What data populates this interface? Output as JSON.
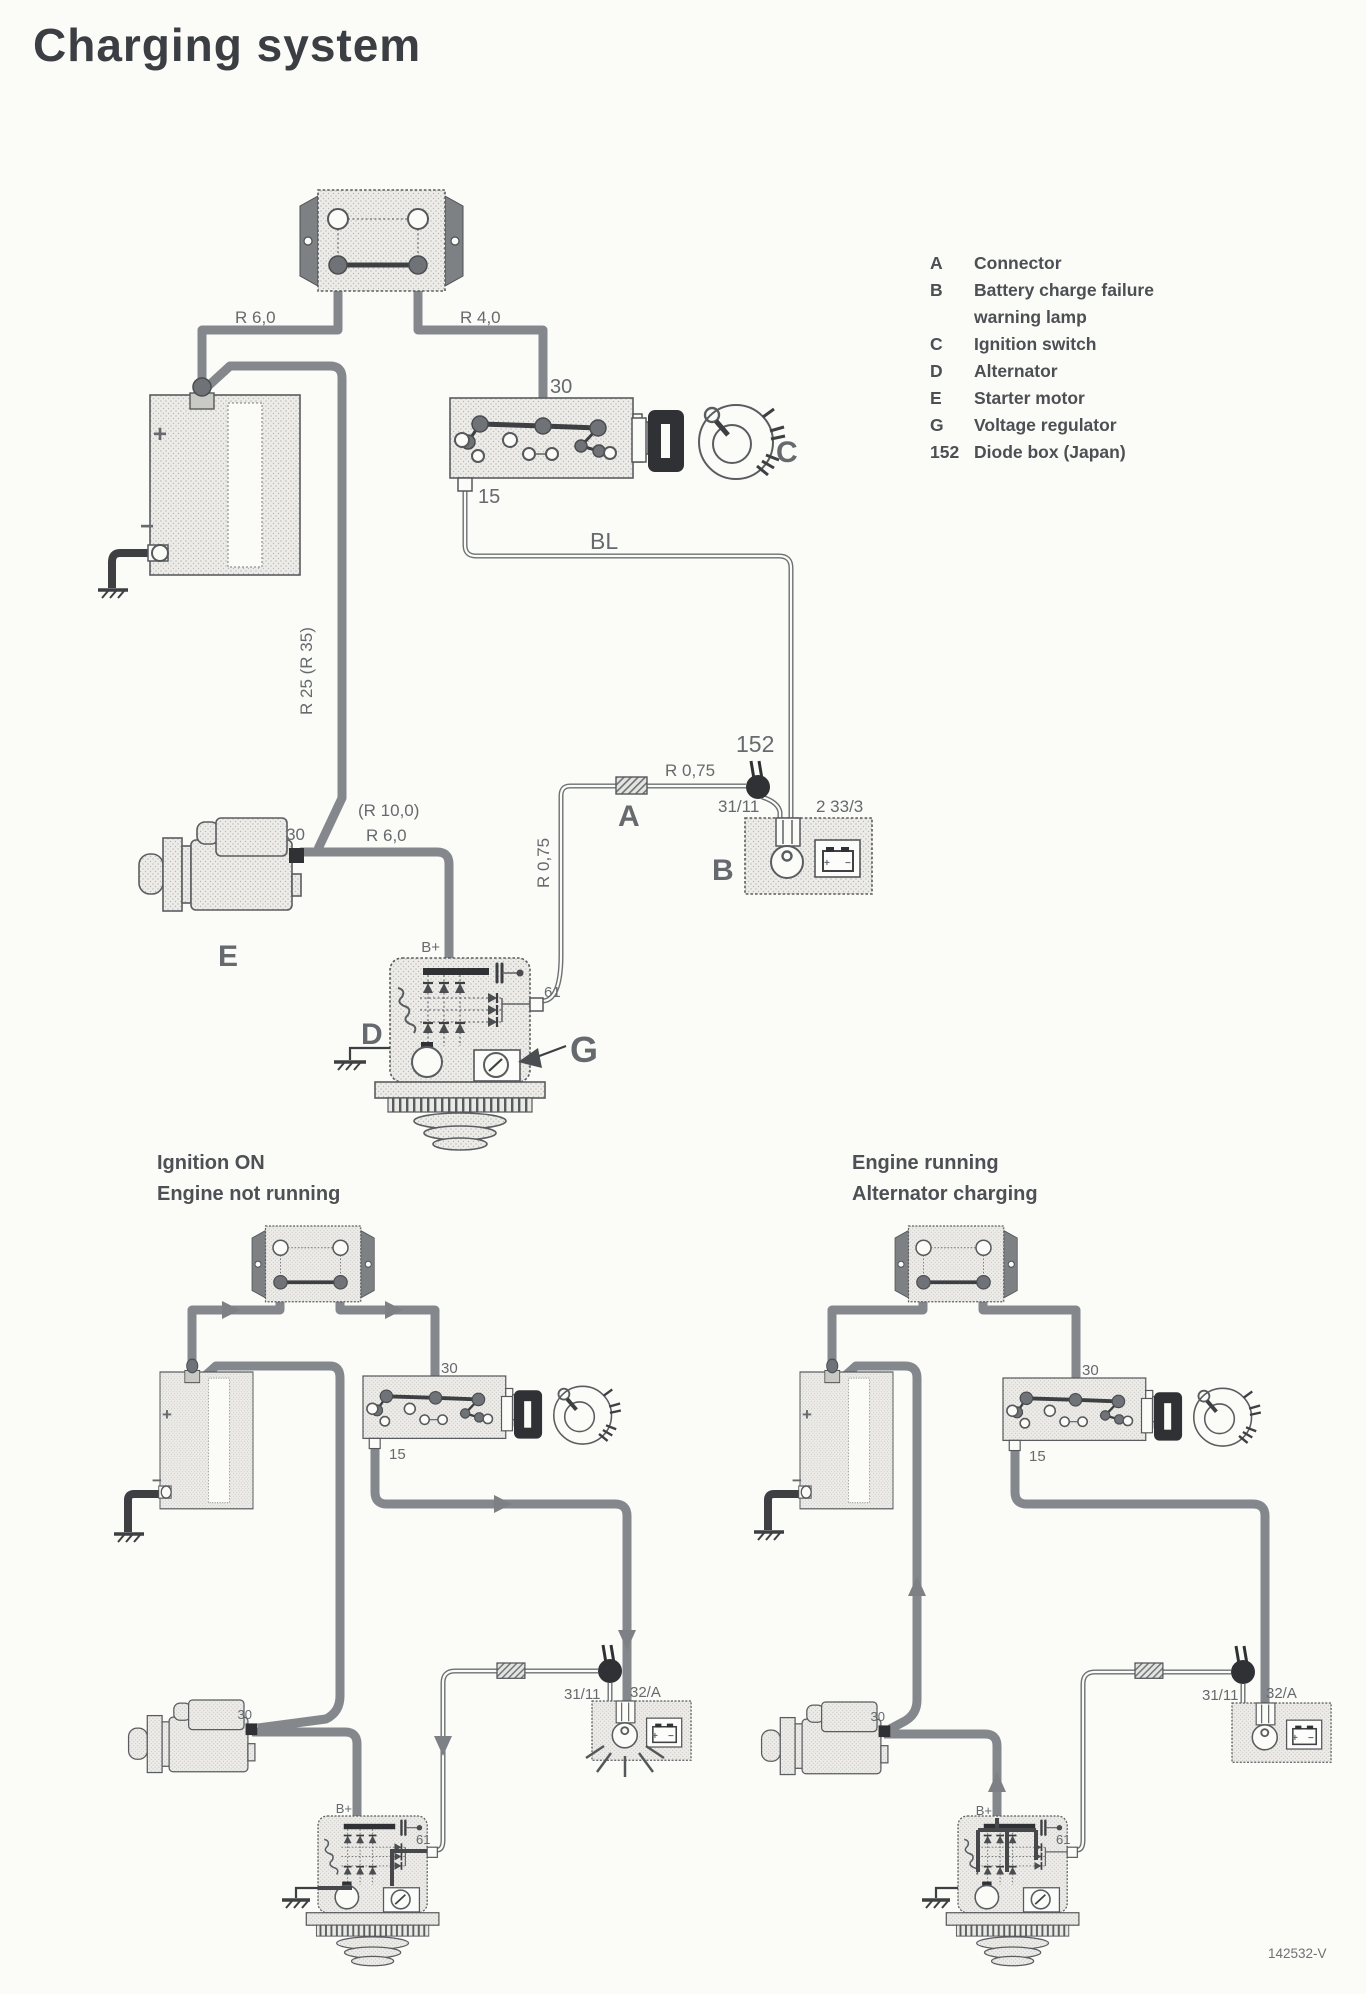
{
  "page": {
    "title": "Charging system"
  },
  "legend": {
    "items": [
      {
        "key": "A",
        "label": "Connector"
      },
      {
        "key": "B",
        "label": "Battery charge failure warning lamp"
      },
      {
        "key": "C",
        "label": "Ignition switch"
      },
      {
        "key": "D",
        "label": "Alternator"
      },
      {
        "key": "E",
        "label": "Starter motor"
      },
      {
        "key": "G",
        "label": "Voltage regulator"
      },
      {
        "key": "152",
        "label": "Diode box (Japan)"
      }
    ]
  },
  "main": {
    "labels": {
      "r60_top": "R 6,0",
      "r40": "R 4,0",
      "sw30": "30",
      "sw15": "15",
      "bl": "BL",
      "r25": "R 25 (R 35)",
      "r100": "(R 10,0)",
      "r60_starter": "R 6,0",
      "r075_h": "R 0,75",
      "r075_v": "R 0,75",
      "box152": "152",
      "t3111": "31/11",
      "t2333": "2 33/3",
      "a": "A",
      "b": "B",
      "c": "C",
      "d": "D",
      "e": "E",
      "g": "G",
      "bplus": "B+",
      "t61": "61",
      "starter30": "30",
      "batt_plus": "+",
      "batt_minus": "−",
      "icon_plus": "+",
      "icon_minus": "−"
    }
  },
  "left": {
    "caption1": "Ignition ON",
    "caption2": "Engine not running",
    "labels": {
      "sw30": "30",
      "sw15": "15",
      "t3111": "31/11",
      "t32a": "32/A",
      "bplus": "B+",
      "t61": "61",
      "starter30": "30",
      "batt_plus": "+",
      "batt_minus": "−",
      "icon_plus": "+",
      "icon_minus": "−"
    }
  },
  "right": {
    "caption1": "Engine running",
    "caption2": "Alternator charging",
    "labels": {
      "sw30": "30",
      "sw15": "15",
      "t3111": "31/11",
      "t32a": "32/A",
      "bplus": "B+",
      "t61": "61",
      "starter30": "30",
      "batt_plus": "+",
      "batt_minus": "−",
      "icon_plus": "+",
      "icon_minus": "−"
    }
  },
  "footer": {
    "doc_number": "142532-V"
  },
  "colors": {
    "paper": "#fbfbf8",
    "ink": "#3b3e42",
    "wire_gray": "#84878b",
    "dark_contact": "#2f3134",
    "component_fill": "#ededea",
    "label_gray": "#66696d"
  }
}
